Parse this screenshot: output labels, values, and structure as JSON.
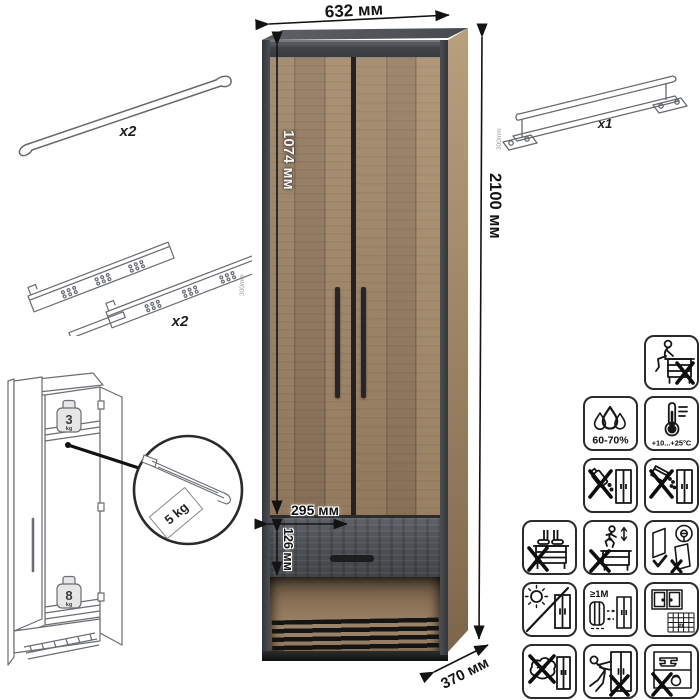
{
  "colors": {
    "background": "#ffffff",
    "frame_dark": "#3e4246",
    "wood_light": "#aa8f6e",
    "wood_dark": "#7d6750",
    "drawer_gray": "#4d5156",
    "lineart_gray": "#666a6e",
    "icon_stroke": "#161616"
  },
  "main_cabinet": {
    "dim_width": "632 мм",
    "dim_height": "2100 мм",
    "dim_depth": "370 мм",
    "dim_door_height": "1074 мм",
    "dim_inner_width": "295 мм",
    "dim_drawer_height": "126 мм"
  },
  "hardware": {
    "hanger_rod": {
      "qty": "x2"
    },
    "drawer_slides": {
      "qty": "x2",
      "length_label": "300mm"
    },
    "wall_rail": {
      "qty": "x1",
      "length_label": "300mm"
    }
  },
  "load_limits": {
    "top_shelf_value": "3",
    "top_shelf_unit": "kg",
    "bottom_shelf_value": "8",
    "bottom_shelf_unit": "kg",
    "pullout_rail_label": "5 kg"
  },
  "care_icons": {
    "humidity_label": "60-70%",
    "temperature_label": "+10...+25°C",
    "distance_label": "≥1M",
    "calendar_label": "21"
  }
}
